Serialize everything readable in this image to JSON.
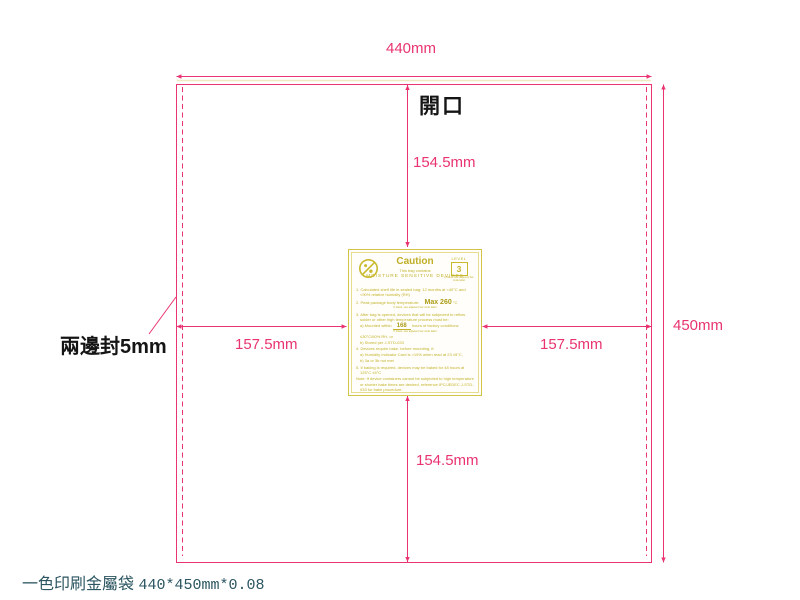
{
  "drawing": {
    "product_title_cjk": "一色印刷金屬袋",
    "product_title_spec": "440*450mm*0.08",
    "opening_label": "開口",
    "side_seal_label": "兩邊封5mm",
    "dim_width": "440mm",
    "dim_height": "450mm",
    "dim_top_half": "154.5mm",
    "dim_bottom_half": "154.5mm",
    "dim_left_half": "157.5mm",
    "dim_right_half": "157.5mm"
  },
  "colors": {
    "dimension_pink": "#e93372",
    "label_yellow": "#c2b22b",
    "title_teal": "#2b5560"
  },
  "msd_label": {
    "title": "Caution",
    "subtitle": "This bag contains",
    "heading": "MOISTURE SENSITIVE DEVICES",
    "level_caption": "LEVEL",
    "level_value": "3",
    "level_note": "If blank, see adjacent bar code label",
    "item1": "1. Calculated shelf life in sealed bag: 12 months at <40°C and <90% relative humidity (RH)",
    "item2_prefix": "2. Peak package body temperature:",
    "item2_value": "Max 260",
    "item2_suffix": "°C",
    "item2_note": "If blank, see adjacent bar code label",
    "item3": "3. After bag is opened, devices that will be subjected to reflow solder or other high temperature process must be:",
    "item3a_prefix": "a) Mounted within",
    "item3a_value": "168",
    "item3a_suffix": "hours of factory conditions",
    "item3a_note": "If blank, see adjacent bar code label",
    "item3a_cont": "≤30°C/60% RH, or",
    "item3b": "b) Stored per J-STD-033",
    "item4": "4. Devices require bake, before mounting, if:",
    "item4a": "a) Humidity Indicator Card is >10% when read at 23 ±5°C,",
    "item4b": "b) 3a or 3b not met",
    "item5": "5. If baking is required, devices may be baked for 48 hours at 125°C ±5°C",
    "note": "Note: If device containers cannot be subjected to high temperature or shorter bake times are desired, reference IPC/JEDEC J-STD-033 for bake procedure.",
    "seal_date_label": "Bag Seal Date:",
    "seal_date_note": "If blank, see adjacent bar code label",
    "footer_note": "Note: Level and body temperature defined by IPC/JEDEC J-STD-020"
  }
}
